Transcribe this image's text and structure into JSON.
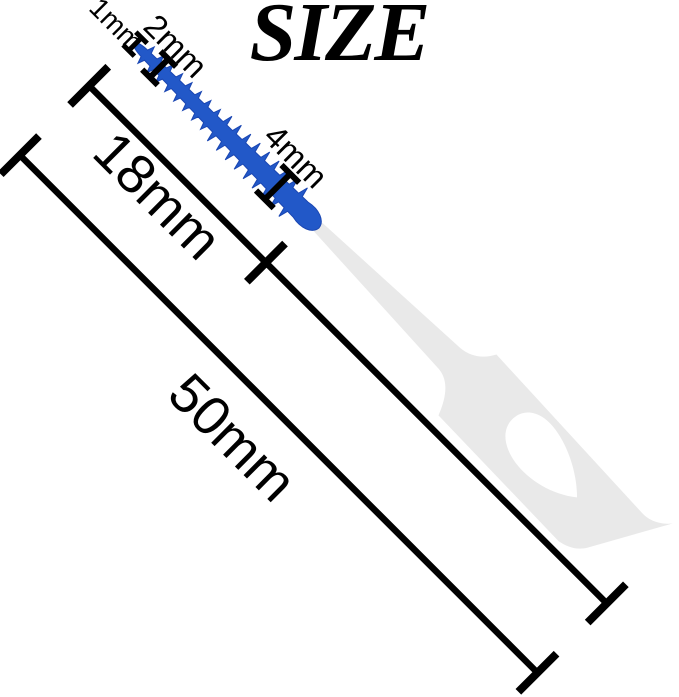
{
  "title": "SIZE",
  "diagram": {
    "product_name": "interdental-brush-pick",
    "measurements": {
      "tip_width": "1mm",
      "brush_start_width": "2mm",
      "brush_end_width": "4mm",
      "brush_length": "18mm",
      "total_length": "50mm"
    },
    "colors": {
      "brush_blue": "#2258c8",
      "brush_edge_blue": "#1a46b2",
      "handle_gray": "#e9e9e9",
      "hole_white": "#ffffff",
      "annotation_black": "#000000"
    }
  }
}
